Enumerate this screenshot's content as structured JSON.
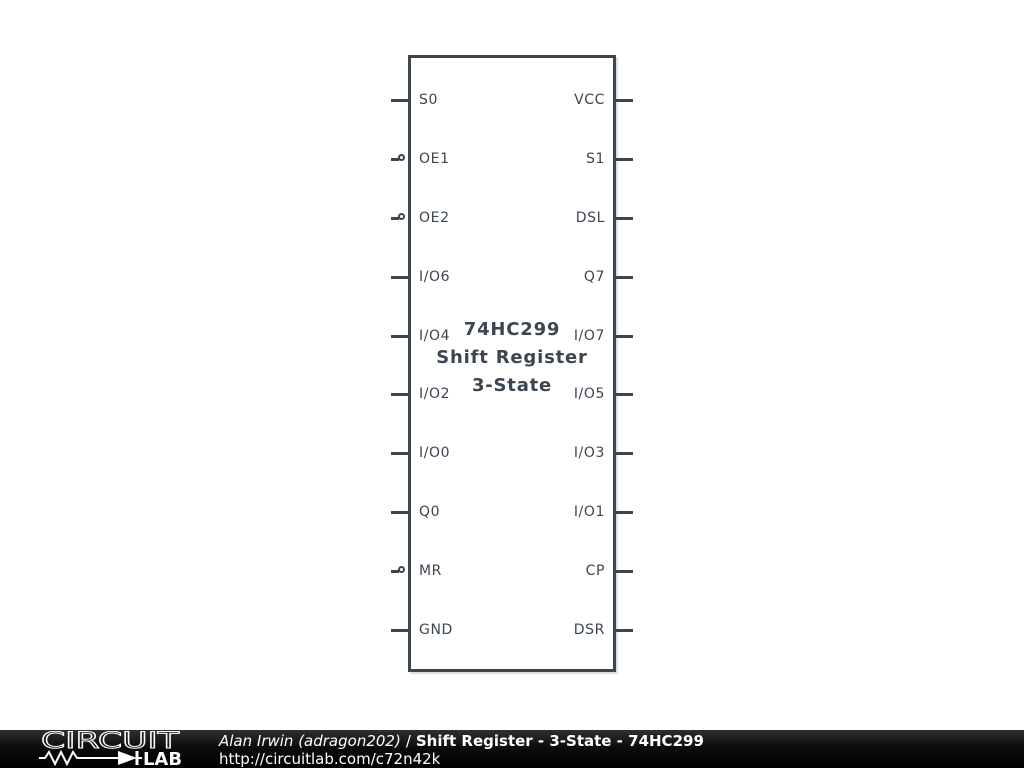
{
  "chip": {
    "part_number": "74HC299",
    "description_line1": "Shift Register",
    "description_line2": "3-State",
    "ink_color": "#3c4650",
    "pins": {
      "left": [
        {
          "label": "S0",
          "inverted": false
        },
        {
          "label": "OE1",
          "inverted": true
        },
        {
          "label": "OE2",
          "inverted": true
        },
        {
          "label": "I/O6",
          "inverted": false
        },
        {
          "label": "I/O4",
          "inverted": false
        },
        {
          "label": "I/O2",
          "inverted": false
        },
        {
          "label": "I/O0",
          "inverted": false
        },
        {
          "label": "Q0",
          "inverted": false
        },
        {
          "label": "MR",
          "inverted": true
        },
        {
          "label": "GND",
          "inverted": false
        }
      ],
      "right": [
        {
          "label": "VCC",
          "inverted": false
        },
        {
          "label": "S1",
          "inverted": false
        },
        {
          "label": "DSL",
          "inverted": false
        },
        {
          "label": "Q7",
          "inverted": false
        },
        {
          "label": "I/O7",
          "inverted": false
        },
        {
          "label": "I/O5",
          "inverted": false
        },
        {
          "label": "I/O3",
          "inverted": false
        },
        {
          "label": "I/O1",
          "inverted": false
        },
        {
          "label": "CP",
          "inverted": false
        },
        {
          "label": "DSR",
          "inverted": false
        }
      ]
    }
  },
  "footer": {
    "logo": {
      "word_top": "CIRCUIT",
      "word_bottom": "LAB"
    },
    "author": "Alan Irwin (adragon202)",
    "separator": "/",
    "sheet_title": "Shift Register - 3-State - 74HC299",
    "url": "http://circuitlab.com/c72n42k"
  }
}
